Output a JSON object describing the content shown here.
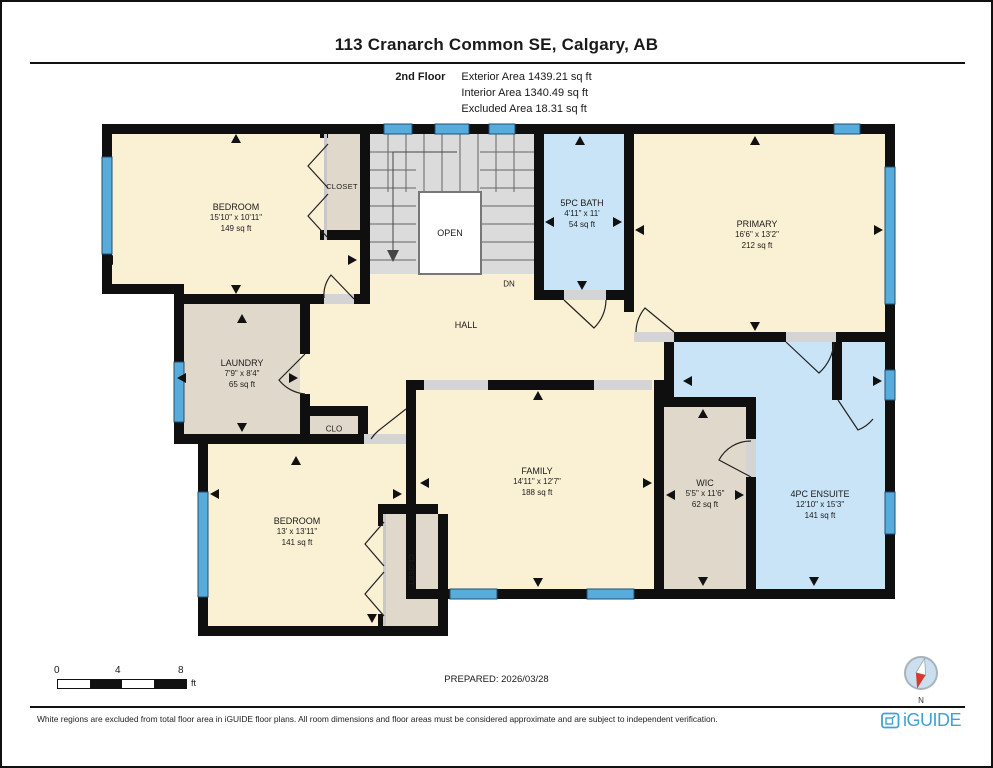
{
  "header": {
    "title": "113 Cranarch Common SE, Calgary, AB",
    "floor_label": "2nd Floor",
    "exterior_area": "Exterior Area 1439.21 sq ft",
    "interior_area": "Interior Area 1340.49 sq ft",
    "excluded_area": "Excluded Area 18.31 sq ft"
  },
  "rooms": {
    "bedroom1": {
      "name": "BEDROOM",
      "dims": "15'10\" x 10'11\"",
      "area": "149 sq ft"
    },
    "closet1": {
      "name": "CLOSET"
    },
    "bath": {
      "name": "5PC BATH",
      "dims": "4'11\" x 11'",
      "area": "54 sq ft"
    },
    "primary": {
      "name": "PRIMARY",
      "dims": "16'6\" x 13'2\"",
      "area": "212 sq ft"
    },
    "laundry": {
      "name": "LAUNDRY",
      "dims": "7'9\" x 8'4\"",
      "area": "65 sq ft"
    },
    "family": {
      "name": "FAMILY",
      "dims": "14'11\" x 12'7\"",
      "area": "188 sq ft"
    },
    "wic": {
      "name": "WIC",
      "dims": "5'5\" x 11'6\"",
      "area": "62 sq ft"
    },
    "ensuite": {
      "name": "4PC ENSUITE",
      "dims": "12'10\" x 15'3\"",
      "area": "141 sq ft"
    },
    "bedroom2": {
      "name": "BEDROOM",
      "dims": "13' x 13'11\"",
      "area": "141 sq ft"
    },
    "closet2": {
      "name": "CLOSET"
    },
    "hall": {
      "name": "HALL"
    },
    "clo": {
      "name": "CLO"
    },
    "open": {
      "name": "OPEN"
    },
    "dn": {
      "name": "DN"
    }
  },
  "scale_bar": {
    "tick0": "0",
    "tick1": "4",
    "tick2": "8",
    "unit": "ft"
  },
  "prepared": "PREPARED: 2026/03/28",
  "compass": {
    "north": "N"
  },
  "footer": {
    "disclaimer": "White regions are excluded from total floor area in iGUIDE floor plans. All room dimensions and floor areas must be considered approximate and are subject to independent verification.",
    "brand": "iGUIDE"
  },
  "colors": {
    "room_cream": "#FAF0D4",
    "room_tan": "#E0D9CB",
    "room_blue": "#C8E4F6",
    "window_blue": "#58ACDC",
    "wall": "#0F0F0F",
    "brand_blue": "#3FA2D3",
    "compass_red": "#D93A30"
  }
}
